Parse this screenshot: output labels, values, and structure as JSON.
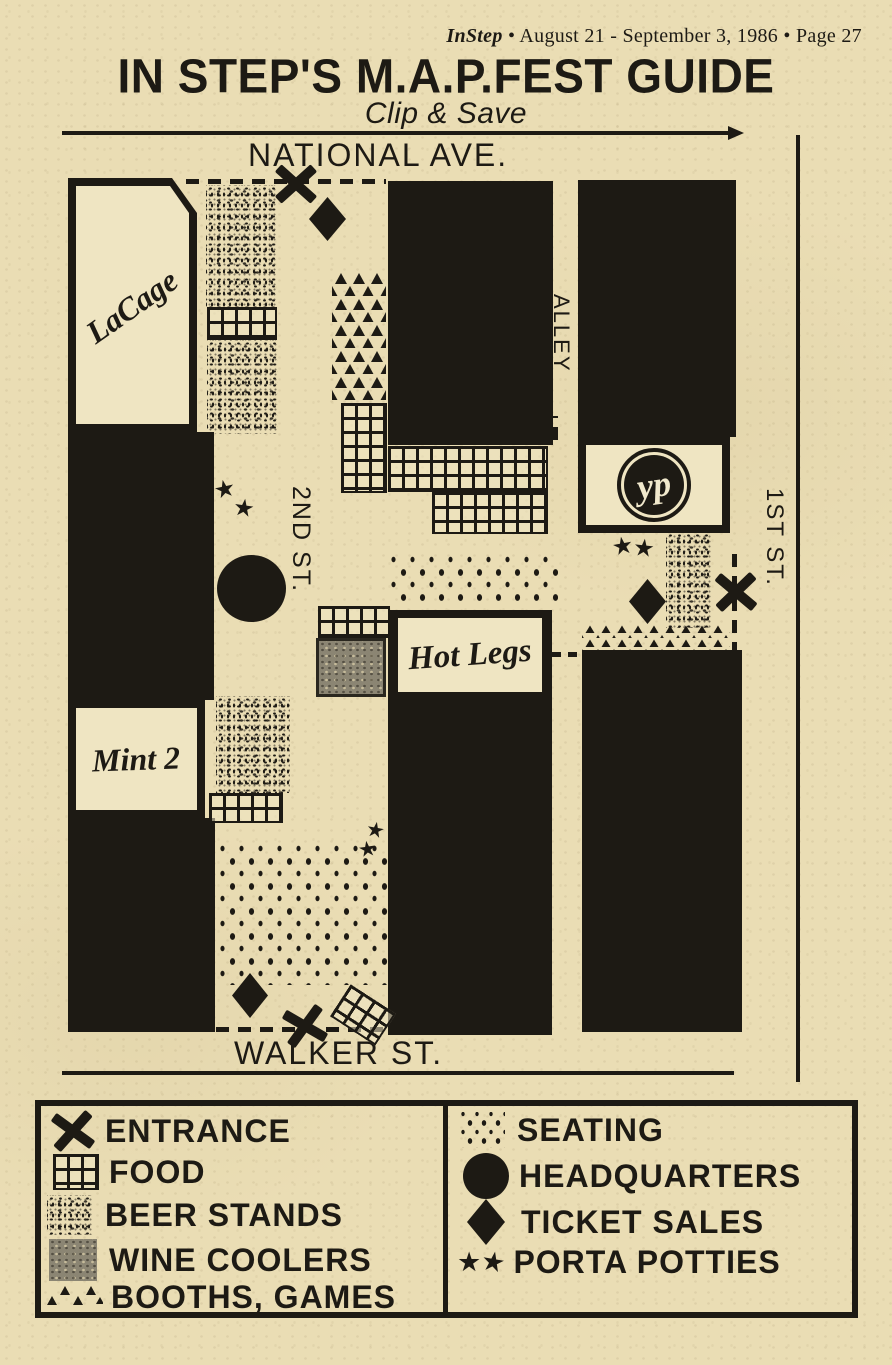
{
  "header": {
    "magazine": "InStep",
    "rest": "• August 21 - September 3, 1986 • Page 27"
  },
  "title": "IN STEP'S M.A.P.FEST GUIDE",
  "subtitle": "Clip & Save",
  "map": {
    "streets": {
      "north": "NATIONAL AVE.",
      "south": "WALKER ST.",
      "east": "1ST ST.",
      "second": "2ND ST.",
      "alley": "ALLEY"
    },
    "venues": {
      "lacage": "LaCage",
      "mint2": "Mint 2",
      "hotlegs": "Hot Legs",
      "yp_logo": "yp"
    }
  },
  "legend": {
    "left": [
      {
        "symbol": "entrance-x",
        "label": "ENTRANCE"
      },
      {
        "symbol": "food-grid",
        "label": "FOOD"
      },
      {
        "symbol": "beer-stipple",
        "label": "BEER STANDS"
      },
      {
        "symbol": "wine-swatch",
        "label": "WINE COOLERS"
      },
      {
        "symbol": "booths-triangles",
        "label": "BOOTHS, GAMES"
      }
    ],
    "right": [
      {
        "symbol": "seating-dots",
        "label": "SEATING"
      },
      {
        "symbol": "headquarters-circle",
        "label": "HEADQUARTERS"
      },
      {
        "symbol": "ticket-diamond",
        "label": "TICKET SALES"
      },
      {
        "symbol": "porta-stars",
        "label": "PORTA POTTIES"
      }
    ]
  },
  "icons": {
    "star": "★"
  },
  "colors": {
    "paper": "#eaddb4",
    "ink": "#1d1a14",
    "wine_gray": "#8b8573"
  }
}
